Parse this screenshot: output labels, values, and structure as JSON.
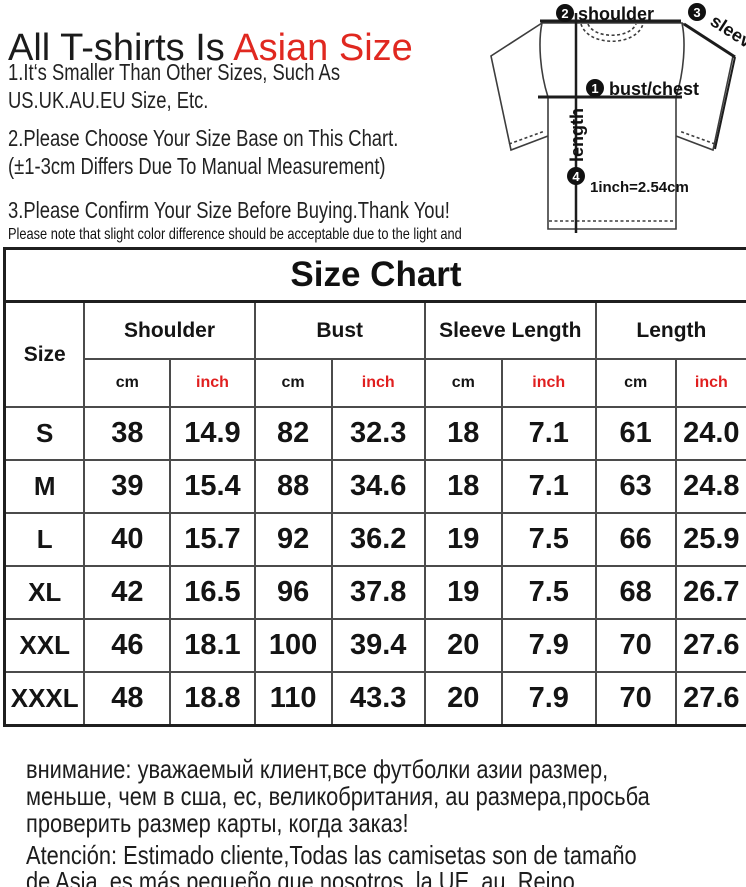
{
  "colors": {
    "accent_red": "#e02820",
    "text_black": "#1b1b1b",
    "table_border": "#4b4b4b",
    "background": "#ffffff"
  },
  "intro": {
    "title_black": "All T-shirts Is ",
    "title_red": "Asian Size",
    "note1": [
      "1.It‘s Smaller Than Other Sizes, Such As",
      "US.UK.AU.EU Size, Etc."
    ],
    "note2": [
      "2.Please Choose Your Size Base on This Chart.",
      "(±1-3cm Differs Due To Manual Measurement)"
    ],
    "note3": "3.Please Confirm Your Size Before Buying.Thank You!",
    "disclaimer": "Please note that slight color difference should be acceptable due to the light and screen."
  },
  "diagram": {
    "callouts": [
      {
        "num": "1",
        "label": "bust/chest"
      },
      {
        "num": "2",
        "label": "shoulder"
      },
      {
        "num": "3",
        "label": "sleeve"
      },
      {
        "num": "4",
        "label": "length"
      }
    ],
    "conversion": "1inch=2.54cm"
  },
  "size_chart": {
    "title": "Size Chart",
    "row_header": "Size",
    "column_groups": [
      "Shoulder",
      "Bust",
      "Sleeve Length",
      "Length"
    ],
    "units": {
      "cm": "cm",
      "inch": "inch"
    },
    "rows": [
      [
        "S",
        "38",
        "14.9",
        "82",
        "32.3",
        "18",
        "7.1",
        "61",
        "24.0"
      ],
      [
        "M",
        "39",
        "15.4",
        "88",
        "34.6",
        "18",
        "7.1",
        "63",
        "24.8"
      ],
      [
        "L",
        "40",
        "15.7",
        "92",
        "36.2",
        "19",
        "7.5",
        "66",
        "25.9"
      ],
      [
        "XL",
        "42",
        "16.5",
        "96",
        "37.8",
        "19",
        "7.5",
        "68",
        "26.7"
      ],
      [
        "XXL",
        "46",
        "18.1",
        "100",
        "39.4",
        "20",
        "7.9",
        "70",
        "27.6"
      ],
      [
        "XXXL",
        "48",
        "18.8",
        "110",
        "43.3",
        "20",
        "7.9",
        "70",
        "27.6"
      ]
    ]
  },
  "footer": {
    "russian": [
      "внимание: уважаемый клиент,все футболки азии размер,",
      "меньше, чем в сша, ес, великобритания, au размера,просьба",
      "проверить размер карты, когда заказ!"
    ],
    "spanish": [
      "Atención: Estimado cliente,Todas las camisetas son de tamaño",
      "de Asia, es más pequeño que nosotros, la UE, au, Reino",
      "Unido,¡Pls comprobar tabla de tamaño cuando lugar una orden!"
    ]
  },
  "chart_data": {
    "type": "table",
    "title": "Size Chart",
    "columns": [
      "Size",
      "Shoulder cm",
      "Shoulder inch",
      "Bust cm",
      "Bust inch",
      "Sleeve Length cm",
      "Sleeve Length inch",
      "Length cm",
      "Length inch"
    ],
    "rows": [
      [
        "S",
        38,
        14.9,
        82,
        32.3,
        18,
        7.1,
        61,
        24.0
      ],
      [
        "M",
        39,
        15.4,
        88,
        34.6,
        18,
        7.1,
        63,
        24.8
      ],
      [
        "L",
        40,
        15.7,
        92,
        36.2,
        19,
        7.5,
        66,
        25.9
      ],
      [
        "XL",
        42,
        16.5,
        96,
        37.8,
        19,
        7.5,
        68,
        26.7
      ],
      [
        "XXL",
        46,
        18.1,
        100,
        39.4,
        20,
        7.9,
        70,
        27.6
      ],
      [
        "XXXL",
        48,
        18.8,
        110,
        43.3,
        20,
        7.9,
        70,
        27.6
      ]
    ]
  }
}
